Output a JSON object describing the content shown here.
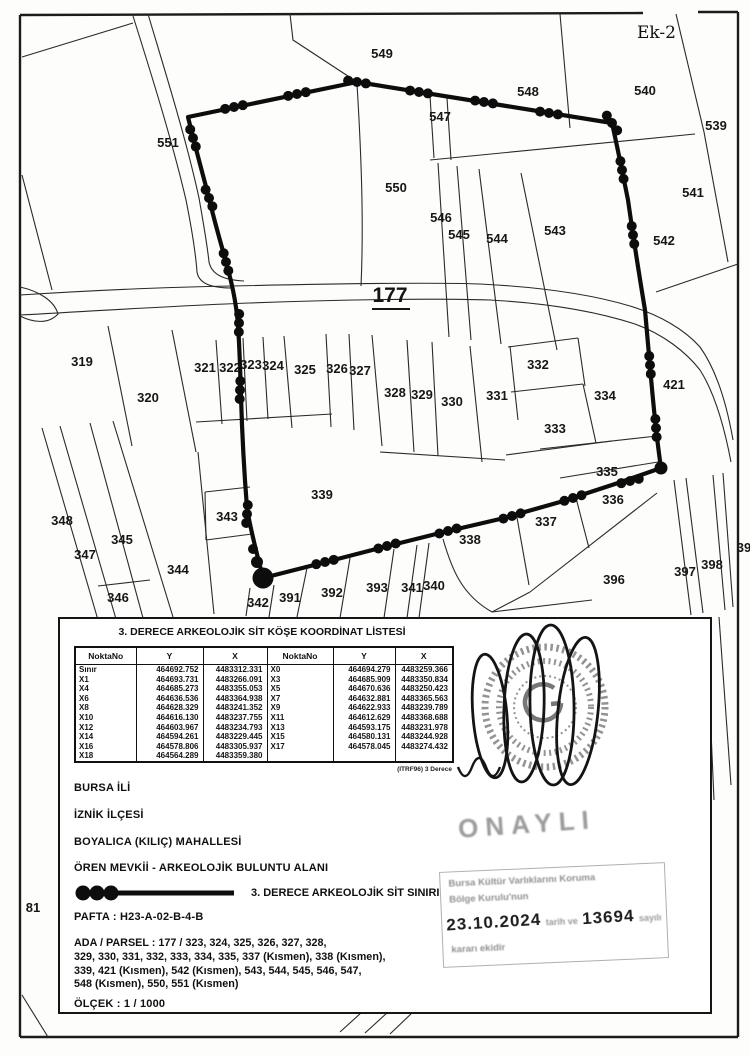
{
  "page": {
    "ek_label": "Ek-2"
  },
  "map": {
    "road_label": {
      "t": "177",
      "x": 390,
      "y": 302
    },
    "parcel_labels": [
      {
        "t": "549",
        "x": 382,
        "y": 58
      },
      {
        "t": "548",
        "x": 528,
        "y": 96
      },
      {
        "t": "540",
        "x": 645,
        "y": 95
      },
      {
        "t": "539",
        "x": 716,
        "y": 130
      },
      {
        "t": "547",
        "x": 440,
        "y": 121
      },
      {
        "t": "551",
        "x": 168,
        "y": 147
      },
      {
        "t": "550",
        "x": 396,
        "y": 192
      },
      {
        "t": "546",
        "x": 441,
        "y": 222
      },
      {
        "t": "545",
        "x": 459,
        "y": 239
      },
      {
        "t": "544",
        "x": 497,
        "y": 243
      },
      {
        "t": "543",
        "x": 555,
        "y": 235
      },
      {
        "t": "542",
        "x": 664,
        "y": 245
      },
      {
        "t": "541",
        "x": 693,
        "y": 197
      },
      {
        "t": "421",
        "x": 674,
        "y": 389
      },
      {
        "t": "319",
        "x": 82,
        "y": 366
      },
      {
        "t": "320",
        "x": 148,
        "y": 402
      },
      {
        "t": "321",
        "x": 205,
        "y": 372
      },
      {
        "t": "322",
        "x": 230,
        "y": 372
      },
      {
        "t": "323",
        "x": 251,
        "y": 369
      },
      {
        "t": "324",
        "x": 273,
        "y": 370
      },
      {
        "t": "325",
        "x": 305,
        "y": 374
      },
      {
        "t": "326",
        "x": 337,
        "y": 373
      },
      {
        "t": "327",
        "x": 360,
        "y": 375
      },
      {
        "t": "328",
        "x": 395,
        "y": 397
      },
      {
        "t": "329",
        "x": 422,
        "y": 399
      },
      {
        "t": "330",
        "x": 452,
        "y": 406
      },
      {
        "t": "331",
        "x": 497,
        "y": 400
      },
      {
        "t": "332",
        "x": 538,
        "y": 369
      },
      {
        "t": "333",
        "x": 555,
        "y": 433
      },
      {
        "t": "334",
        "x": 605,
        "y": 400
      },
      {
        "t": "335",
        "x": 607,
        "y": 476
      },
      {
        "t": "336",
        "x": 613,
        "y": 504
      },
      {
        "t": "337",
        "x": 546,
        "y": 526
      },
      {
        "t": "338",
        "x": 470,
        "y": 544
      },
      {
        "t": "339",
        "x": 322,
        "y": 499
      },
      {
        "t": "343",
        "x": 227,
        "y": 521
      },
      {
        "t": "344",
        "x": 178,
        "y": 574
      },
      {
        "t": "345",
        "x": 122,
        "y": 544
      },
      {
        "t": "346",
        "x": 118,
        "y": 602
      },
      {
        "t": "347",
        "x": 85,
        "y": 559
      },
      {
        "t": "348",
        "x": 62,
        "y": 525
      },
      {
        "t": "342",
        "x": 258,
        "y": 607
      },
      {
        "t": "391",
        "x": 290,
        "y": 602
      },
      {
        "t": "392",
        "x": 332,
        "y": 597
      },
      {
        "t": "393",
        "x": 377,
        "y": 592
      },
      {
        "t": "341",
        "x": 412,
        "y": 592
      },
      {
        "t": "340",
        "x": 434,
        "y": 590
      },
      {
        "t": "396",
        "x": 614,
        "y": 584
      },
      {
        "t": "397",
        "x": 685,
        "y": 576
      },
      {
        "t": "398",
        "x": 712,
        "y": 569
      },
      {
        "t": "39",
        "x": 744,
        "y": 552
      },
      {
        "t": "81",
        "x": 33,
        "y": 912
      }
    ]
  },
  "info_box": {
    "table_title": "3. DERECE ARKEOLOJİK SİT KÖŞE KOORDİNAT LİSTESİ",
    "col_headers": [
      "NoktaNo",
      "Y",
      "X",
      "NoktaNo",
      "Y",
      "X"
    ],
    "rows_left": [
      [
        "Sınır",
        "464692.752",
        "4483312.331"
      ],
      [
        "X1",
        "464693.731",
        "4483266.091"
      ],
      [
        "X4",
        "464685.273",
        "4483355.053"
      ],
      [
        "X6",
        "464636.536",
        "4483364.938"
      ],
      [
        "X8",
        "464628.329",
        "4483241.352"
      ],
      [
        "X10",
        "464616.130",
        "4483237.755"
      ],
      [
        "X12",
        "464603.967",
        "4483234.793"
      ],
      [
        "X14",
        "464594.261",
        "4483229.445"
      ],
      [
        "X16",
        "464578.806",
        "4483305.937"
      ],
      [
        "X18",
        "464564.289",
        "4483359.380"
      ]
    ],
    "rows_right": [
      [
        "X0",
        "464694.279",
        "4483259.366"
      ],
      [
        "X3",
        "464685.909",
        "4483350.834"
      ],
      [
        "X5",
        "464670.636",
        "4483250.423"
      ],
      [
        "X7",
        "464632.881",
        "4483365.563"
      ],
      [
        "X9",
        "464622.933",
        "4483239.789"
      ],
      [
        "X11",
        "464612.629",
        "4483368.688"
      ],
      [
        "X13",
        "464593.175",
        "4483231.978"
      ],
      [
        "X15",
        "464580.131",
        "4483244.928"
      ],
      [
        "X17",
        "464578.045",
        "4483274.432"
      ]
    ],
    "table_note": "(ITRF96) 3 Derece",
    "lines": {
      "province": "BURSA İLİ",
      "district": "İZNİK İLÇESİ",
      "neighborhood": "BOYALICA (KILIÇ) MAHALLESİ",
      "site": "ÖREN MEVKİİ - ARKEOLOJİK BULUNTU ALANI",
      "legend": "3. DERECE ARKEOLOJİK SİT SINIRI",
      "pafta": "PAFTA : H23-A-02-B-4-B",
      "ada_parsel_lines": [
        "ADA / PARSEL : 177 / 323, 324, 325, 326, 327, 328,",
        "329, 330, 331, 332, 333, 334, 335, 337 (Kısmen), 338 (Kısmen),",
        "339, 421 (Kısmen), 542 (Kısmen), 543, 544, 545, 546, 547,",
        "548 (Kısmen), 550, 551 (Kısmen)"
      ],
      "olcek": "ÖLÇEK : 1 / 1000"
    },
    "stamps": {
      "onay": "ONAYLI",
      "rect_line1": "Bursa Kültür Varlıklarını Koruma",
      "rect_line2": "Bölge Kurulu'nun",
      "mid_pre": "tarih ve",
      "date": "23.10.2024",
      "number": "13694",
      "mid_post": "sayılı",
      "rect_line4": "kararı ekidir"
    }
  },
  "colors": {
    "ink": "#161616",
    "boundary": "#0d0d0d"
  }
}
